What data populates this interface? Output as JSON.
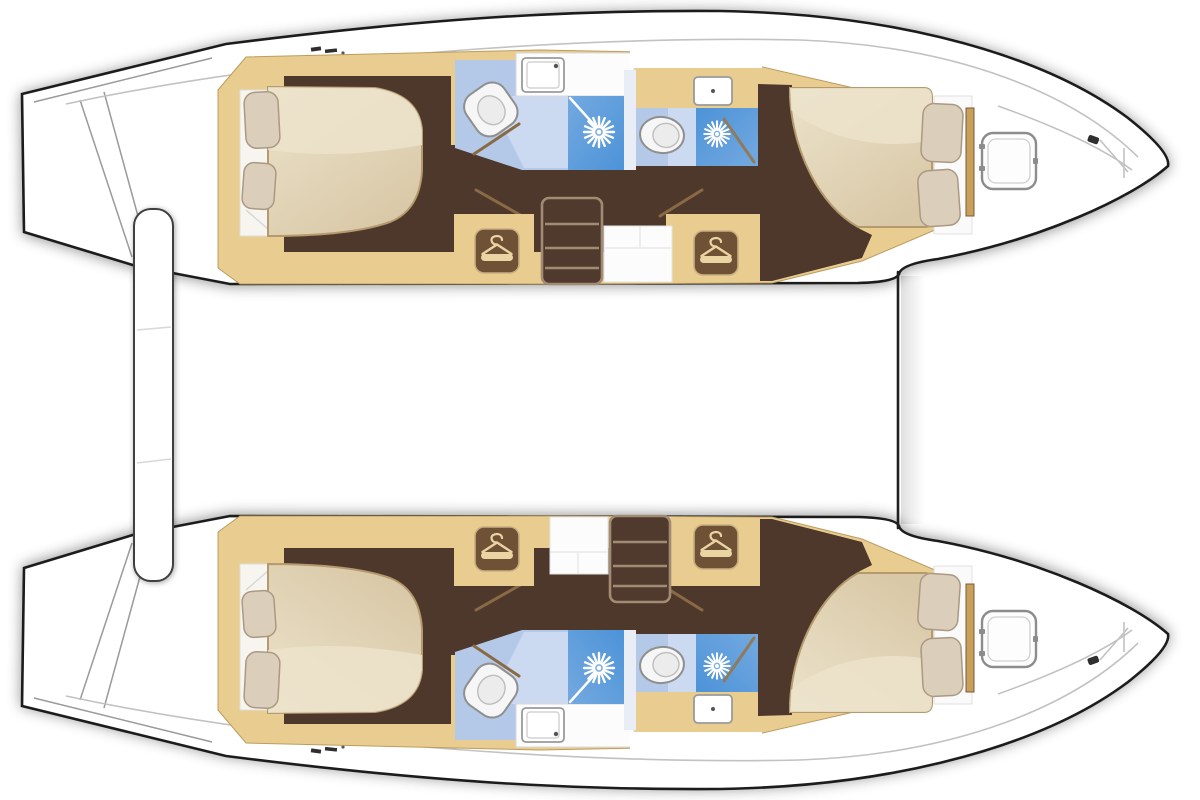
{
  "page": {
    "background": "#ffffff",
    "description": "catamaran-interior-floor-plan",
    "orientation": {
      "bow": "right",
      "stern": "left"
    }
  },
  "colors": {
    "hull_outline": "#1b1b1b",
    "hull_fill": "#ffffff",
    "wood": "#e9cd90",
    "wood_edge": "#bc9c5f",
    "floor_dark": "#4e372b",
    "mattress": "#d9c8a7",
    "mattress_top": "#ece3cb",
    "mattress_edge": "#b49a6e",
    "pillow": "#dbceba",
    "pillow_edge": "#ab9982",
    "bath_light": "#b4c9e7",
    "bath_lighter": "#ccdaf1",
    "shower_deep": "#4c93d8",
    "shower_soft": "#74a9e0",
    "fixture_white": "#f6f6f6",
    "fixture_outline": "#8f8f8f",
    "hanger_box": "#6f5136",
    "hanger_icon": "#e9d4a2",
    "stair_fill": "#503a2d",
    "stair_line": "#a18b75",
    "door_line": "#8a6a45",
    "deck_line": "#c2c2c2",
    "divider_line": "#202020"
  },
  "hulls": [
    {
      "name": "port-hull",
      "position": "top",
      "rooms": [
        {
          "name": "aft-cabin",
          "features": [
            "double-berth",
            "two-pillows",
            "wardrobe-with-hanger"
          ]
        },
        {
          "name": "aft-head",
          "features": [
            "toilet",
            "sink",
            "shower-with-rose"
          ]
        },
        {
          "name": "companionway",
          "features": [
            "stairs",
            "landing"
          ]
        },
        {
          "name": "forward-head",
          "features": [
            "toilet",
            "sink",
            "shower-with-rose"
          ]
        },
        {
          "name": "forward-cabin",
          "features": [
            "double-berth",
            "two-pillows",
            "wardrobe-with-hanger"
          ]
        },
        {
          "name": "foredeck",
          "features": [
            "deck-hatch",
            "bow-cleat"
          ]
        }
      ]
    },
    {
      "name": "starboard-hull",
      "position": "bottom",
      "rooms": [
        {
          "name": "aft-cabin",
          "features": [
            "double-berth",
            "two-pillows",
            "wardrobe-with-hanger"
          ]
        },
        {
          "name": "aft-head",
          "features": [
            "toilet",
            "sink",
            "shower-with-rose"
          ]
        },
        {
          "name": "companionway",
          "features": [
            "stairs",
            "landing"
          ]
        },
        {
          "name": "forward-head",
          "features": [
            "toilet",
            "sink",
            "shower-with-rose"
          ]
        },
        {
          "name": "forward-cabin",
          "features": [
            "double-berth",
            "two-pillows",
            "wardrobe-with-hanger"
          ]
        },
        {
          "name": "foredeck",
          "features": [
            "deck-hatch",
            "bow-cleat"
          ]
        }
      ]
    }
  ],
  "shared_structure": [
    "aft-crossbeam-platform",
    "stern-transom-steps",
    "foredeck-crossbar"
  ]
}
